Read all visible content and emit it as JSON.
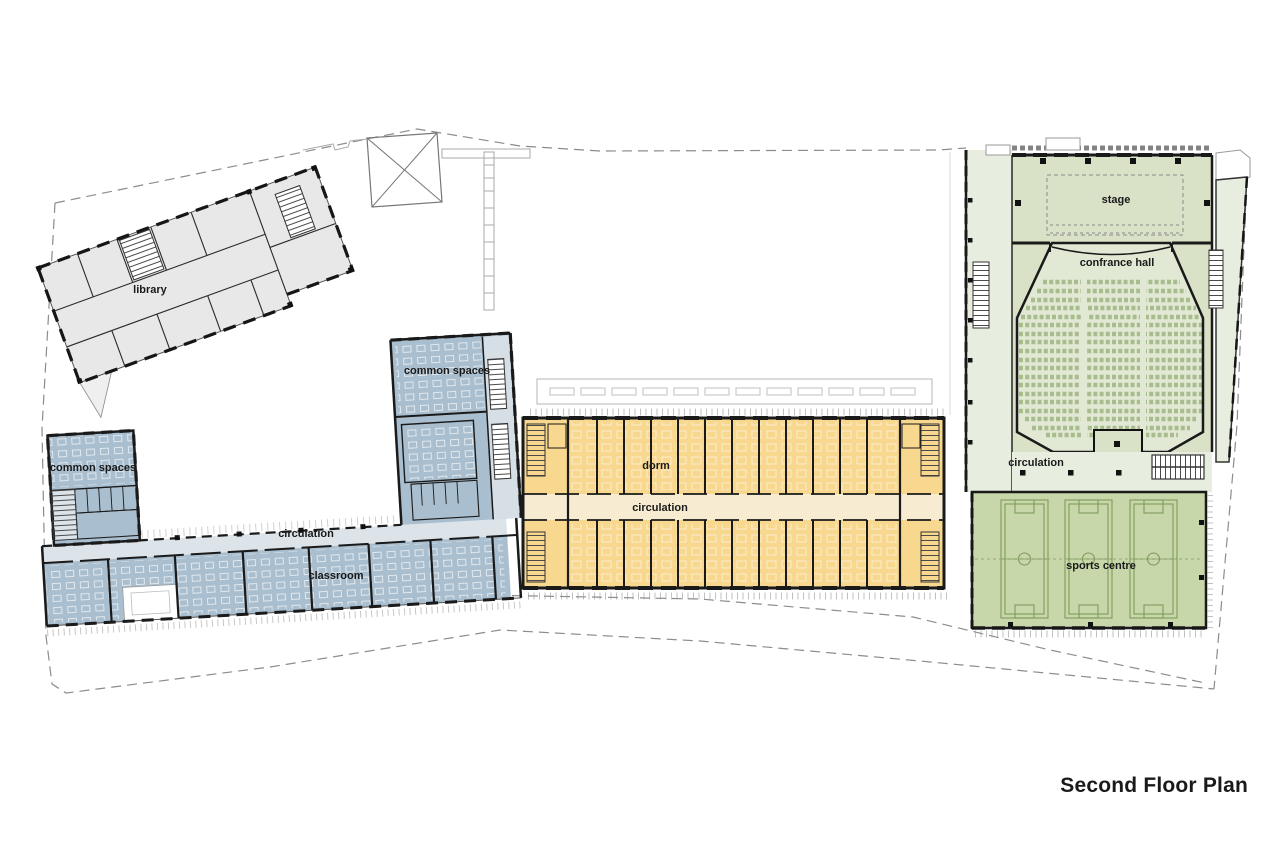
{
  "page_title": "Second Floor Plan",
  "labels": {
    "library": "library",
    "common_spaces_left": "common spaces",
    "common_spaces_upper": "common spaces",
    "school_circulation": "circulation",
    "classroom": "classroom",
    "dorm": "dorm",
    "dorm_circulation": "circulation",
    "stage": "stage",
    "conference_hall": "confrance hall",
    "hall_circulation": "circulation",
    "sports_centre": "sports centre"
  },
  "colors": {
    "library_fill": "#e8e8e8",
    "school_room_fill": "#a9bece",
    "school_corridor_fill": "#dce4ea",
    "dorm_room_fill": "#f8d78f",
    "dorm_corridor_fill": "#f7ecd2",
    "hall_fill": "#d9e2c6",
    "seating_fill": "#e1e8d4",
    "green_circulation_fill": "#e8eedf",
    "sports_fill": "#c7d7a9",
    "wall": "#1a1a1a",
    "label_text": "#1a1a1a"
  }
}
